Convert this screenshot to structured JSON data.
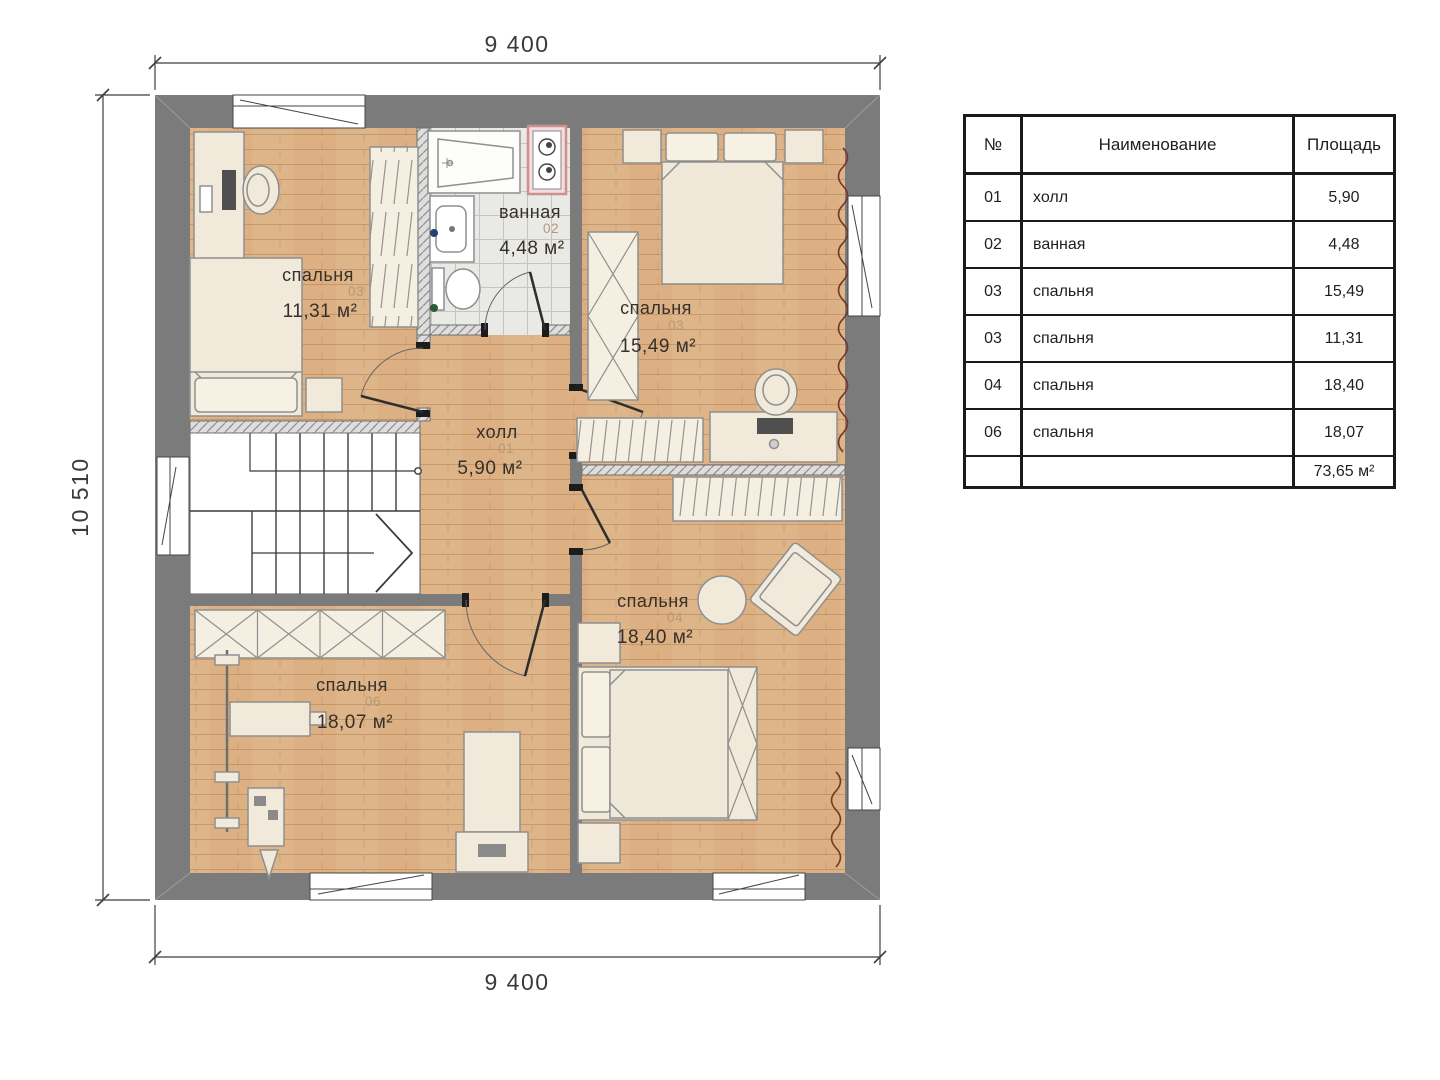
{
  "plan": {
    "dim_top": "9 400",
    "dim_bottom": "9 400",
    "dim_left": "10 510",
    "rooms": [
      {
        "name": "спальня",
        "number": "03",
        "area": "11,31 м²"
      },
      {
        "name": "ванная",
        "number": "02",
        "area": "4,48 м²"
      },
      {
        "name": "спальня",
        "number": "03",
        "area": "15,49 м²"
      },
      {
        "name": "холл",
        "number": "01",
        "area": "5,90 м²"
      },
      {
        "name": "спальня",
        "number": "04",
        "area": "18,40 м²"
      },
      {
        "name": "спальня",
        "number": "06",
        "area": "18,07 м²"
      }
    ]
  },
  "table": {
    "headers": [
      "№",
      "Наименование",
      "Площадь"
    ],
    "rows": [
      {
        "num": "01",
        "name": "холл",
        "area": "5,90"
      },
      {
        "num": "02",
        "name": "ванная",
        "area": "4,48"
      },
      {
        "num": "03",
        "name": "спальня",
        "area": "15,49"
      },
      {
        "num": "03",
        "name": "спальня",
        "area": "11,31"
      },
      {
        "num": "04",
        "name": "спальня",
        "area": "18,40"
      },
      {
        "num": "06",
        "name": "спальня",
        "area": "18,07"
      }
    ],
    "total_area": "73,65 м²"
  },
  "colors": {
    "wall": "#7b7b7b",
    "wood_floor": "#dcb083",
    "tile_floor": "#e9e9e5",
    "furniture": "#f1e9da",
    "washer_pink": "#cf8f8f",
    "radiator": "#76382a",
    "room_number": "#b39a77",
    "text": "#37302a"
  }
}
